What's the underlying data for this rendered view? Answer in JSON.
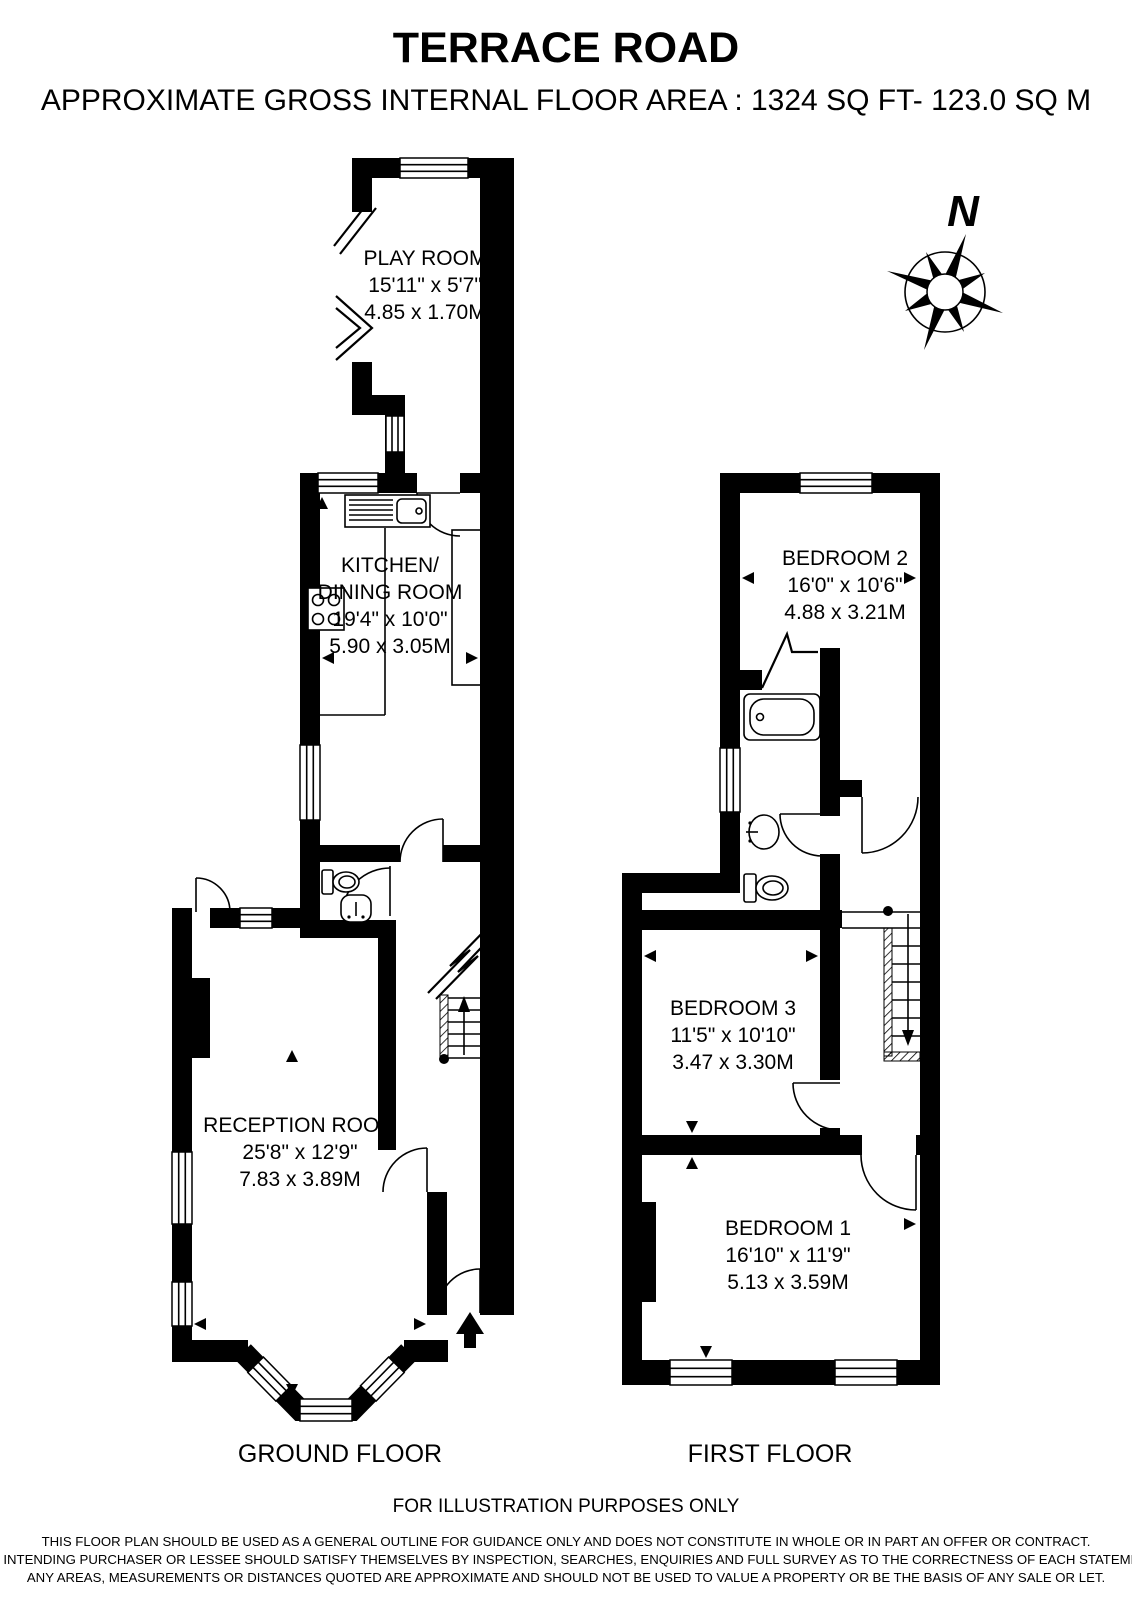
{
  "header": {
    "title": "TERRACE ROAD",
    "subtitle": "APPROXIMATE GROSS INTERNAL FLOOR AREA : 1324 SQ FT- 123.0 SQ M"
  },
  "compass": {
    "north_label": "N"
  },
  "ground_floor": {
    "label": "GROUND FLOOR",
    "play_room": {
      "name": "PLAY ROOM",
      "size_imperial": "15'11\" x 5'7\"",
      "size_metric": "4.85 x 1.70M"
    },
    "kitchen": {
      "name_line1": "KITCHEN/",
      "name_line2": "DINING ROOM",
      "size_imperial": "19'4\" x 10'0\"",
      "size_metric": "5.90 x 3.05M"
    },
    "reception": {
      "name": "RECEPTION ROOM",
      "size_imperial": "25'8\" x 12'9\"",
      "size_metric": "7.83 x 3.89M"
    }
  },
  "first_floor": {
    "label": "FIRST FLOOR",
    "bedroom2": {
      "name": "BEDROOM 2",
      "size_imperial": "16'0\" x 10'6\"",
      "size_metric": "4.88 x 3.21M"
    },
    "bedroom3": {
      "name": "BEDROOM 3",
      "size_imperial": "11'5\" x 10'10\"",
      "size_metric": "3.47 x 3.30M"
    },
    "bedroom1": {
      "name": "BEDROOM 1",
      "size_imperial": "16'10\" x 11'9\"",
      "size_metric": "5.13 x 3.59M"
    }
  },
  "footer": {
    "illustration_note": "FOR ILLUSTRATION PURPOSES ONLY",
    "disclaimer": [
      "THIS FLOOR PLAN SHOULD BE USED AS A GENERAL OUTLINE FOR GUIDANCE ONLY AND DOES NOT CONSTITUTE IN WHOLE OR IN PART AN OFFER OR CONTRACT.",
      "ANY INTENDING PURCHASER OR LESSEE SHOULD SATISFY THEMSELVES BY INSPECTION, SEARCHES, ENQUIRIES AND FULL SURVEY AS TO THE CORRECTNESS OF EACH STATEMENT.",
      "ANY AREAS, MEASUREMENTS OR DISTANCES QUOTED ARE APPROXIMATE AND SHOULD NOT BE USED TO VALUE A PROPERTY OR BE THE BASIS OF ANY SALE OR LET."
    ]
  },
  "colors": {
    "wall": "#000000",
    "background": "#ffffff"
  }
}
